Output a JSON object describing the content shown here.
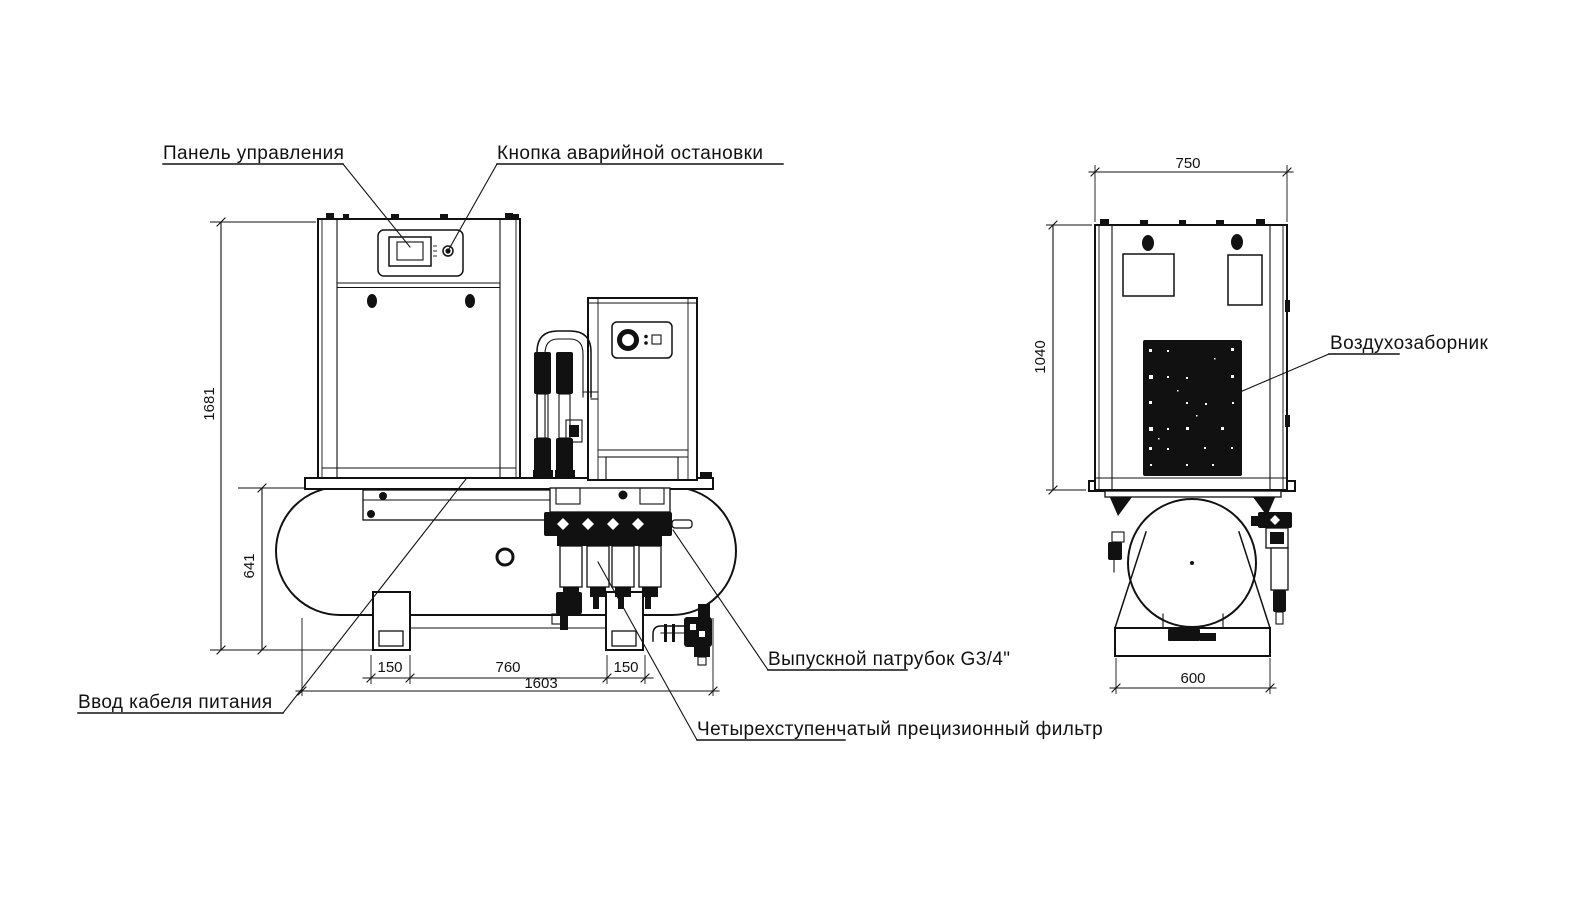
{
  "front_view": {
    "callouts": {
      "control_panel": "Панель управления",
      "emergency_stop": "Кнопка аварийной остановки",
      "power_cable_entry": "Ввод кабеля питания",
      "outlet_port": "Выпускной патрубок G3/4\"",
      "precision_filter": "Четырехступенчатый прецизионный фильтр"
    },
    "dimensions": {
      "overall_height": "1681",
      "tank_assembly_height": "641",
      "left_foot": "150",
      "feet_spacing": "760",
      "right_foot": "150",
      "overall_length": "1603"
    }
  },
  "side_view": {
    "callouts": {
      "air_intake": "Воздухозаборник"
    },
    "dimensions": {
      "cabinet_width": "750",
      "cabinet_height": "1040",
      "base_width": "600"
    }
  },
  "colors": {
    "line": "#111111",
    "background": "#ffffff"
  }
}
